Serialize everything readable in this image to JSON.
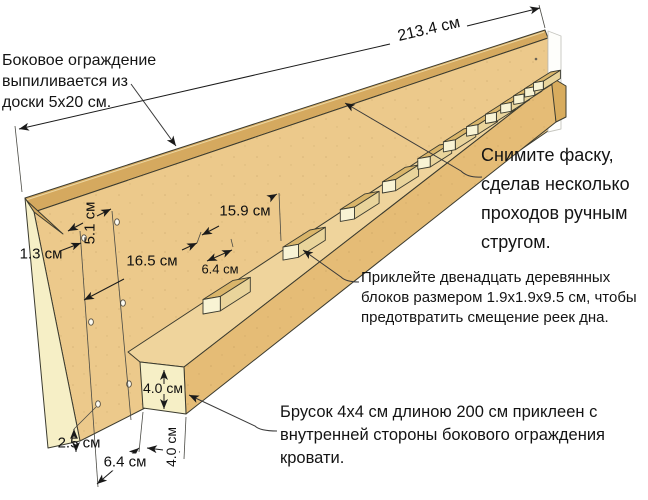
{
  "annotations": {
    "board_note": {
      "lines": [
        "Боковое ограждение",
        "выпиливается из",
        "доски 5х20 см."
      ]
    },
    "chamfer_note": {
      "lines": [
        "Снимите фаску,",
        "сделав несколько",
        "проходов ручным",
        "стругом."
      ]
    },
    "blocks_note": {
      "lines": [
        "Приклейте двенадцать деревянных",
        "блоков размером 1.9х1.9х9.5 см, чтобы",
        "предотвратить смещение реек дна."
      ]
    },
    "cleat_note": {
      "lines": [
        "Брусок 4х4 см длиною 200 см приклеен с",
        "внутренней стороны бокового ограждения",
        "кровати."
      ]
    }
  },
  "dimensions": {
    "overall_length": "213.4 см",
    "hole_column_spacing": "5.1 см",
    "edge_to_hole": "1.3 см",
    "hole_to_block": "16.5 см",
    "block_spacing": "15.9 см",
    "block_length": "6.4 см",
    "cleat_height": "4.0 см",
    "cleat_depth": "4.0 см",
    "hole_to_bottom_edge": "2.5 см",
    "board_end_to_cleat": "6.4 см"
  },
  "colors": {
    "board_face": "#ECC98B",
    "board_edge": "#D5A95F",
    "board_end": "#F6EFC6",
    "rail_face": "#E5BC76",
    "rail_top": "#EFD49C",
    "rail_end": "#F6EFC6",
    "rail_end_right": "#D8AC5E",
    "block_face": "#F8F3D4",
    "block_top": "#D9B56A",
    "block_side": "#E9D49B",
    "outline": "#3B3B2F",
    "dim_line": "#1a1a1a",
    "ghost": "#C6C6C0"
  }
}
